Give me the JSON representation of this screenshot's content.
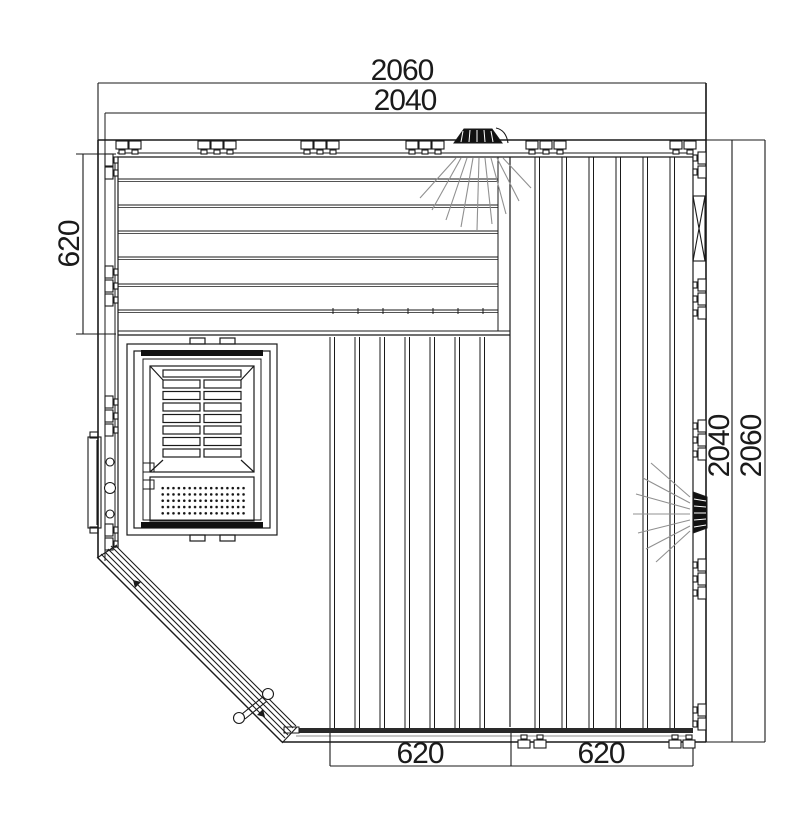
{
  "drawing": {
    "type": "technical floor plan",
    "dimensions": {
      "top_width_outer": "2060",
      "top_width_inner": "2040",
      "bench_depth_left": "620",
      "right_height_inner": "2040",
      "right_height_outer": "2060",
      "floor_section_left": "620",
      "floor_section_right": "620"
    },
    "icons": {
      "ceiling_light": "hatched-trapezoid-with-light-rays",
      "wall_light": "hatched-trapezoid-with-light-rays",
      "wall_connector": "clamp-pin-symbol",
      "vent": "x-crossed-rectangle",
      "heater": "louvered-box-with-perforated-panel",
      "door_handle": "bar-with-two-round-knobs",
      "door": "diagonal-glass-panel-lines"
    },
    "colors": {
      "line": "#1a1a1a",
      "ray": "#909090",
      "dark_fill": "#111111",
      "background": "#ffffff"
    }
  }
}
